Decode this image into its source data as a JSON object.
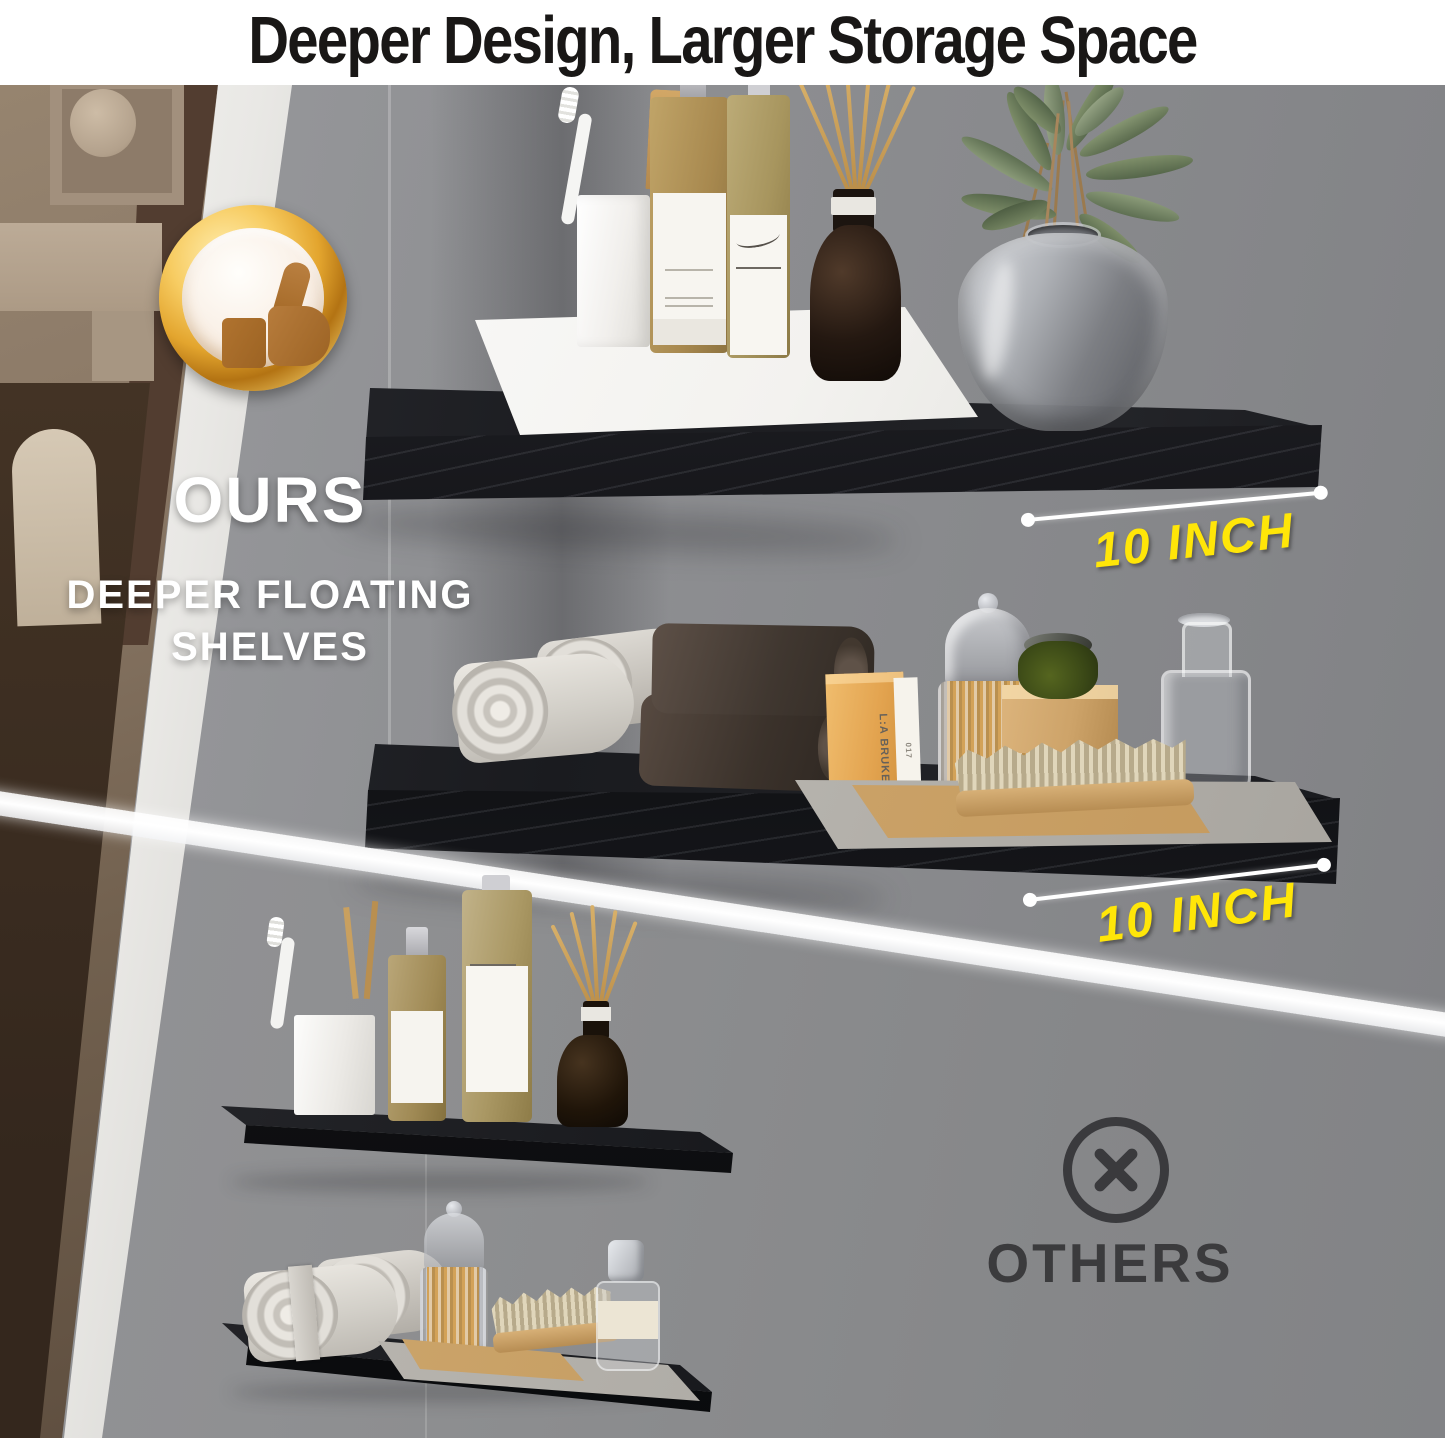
{
  "title": "Deeper Design, Larger Storage Space",
  "ours_section": {
    "heading": "OURS",
    "subheading_line1": "DEEPER FLOATING",
    "subheading_line2": "SHELVES",
    "badge_icon": "thumbs-up-gold-medal",
    "shelf_depth_labels": [
      "10 INCH",
      "10 INCH"
    ]
  },
  "others_section": {
    "heading": "OTHERS",
    "badge_icon": "x-circle"
  },
  "product_box": {
    "brand": "L:A BRUKET",
    "item_number": "017"
  },
  "colors": {
    "accent_yellow": "#ffe608",
    "medal_gold": "#e3a52e",
    "thumb_brown": "#a86d2b",
    "shelf_black": "#17181c",
    "wall_gray": "#8e8f92",
    "others_text": "#3a3a3d",
    "title_text": "#191716",
    "white": "#ffffff"
  }
}
